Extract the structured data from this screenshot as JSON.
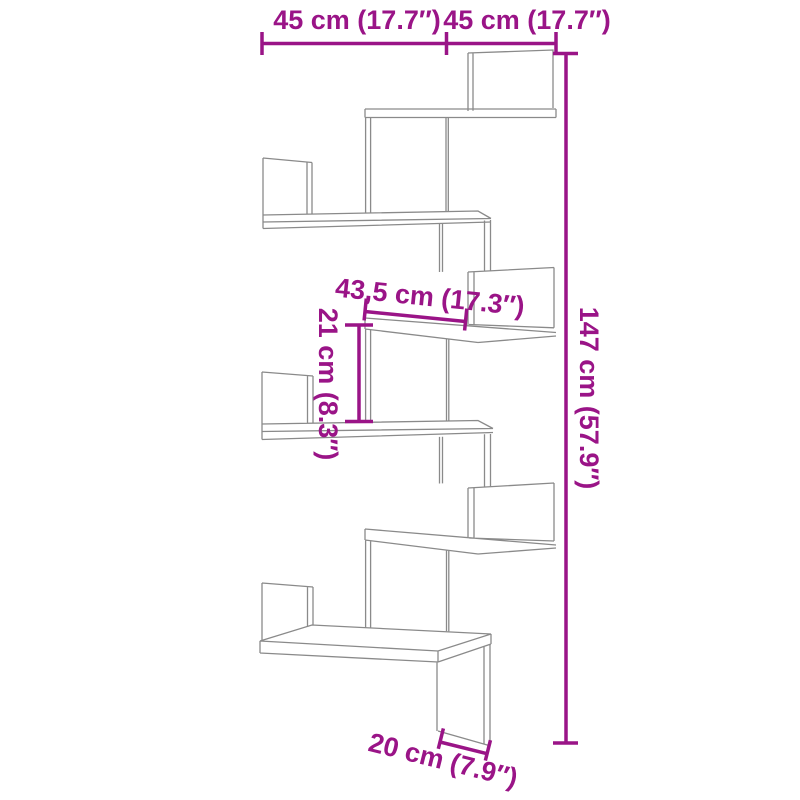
{
  "diagram": {
    "subject": "wall corner shelf dimension drawing",
    "colors": {
      "annotation": "#9a1487",
      "outline": "#8a8a8a",
      "background": "#ffffff"
    },
    "labels": {
      "top_width_left": "45 cm (17.7″)",
      "top_width_right": "45 cm (17.7″)",
      "shelf_width": "43,5 cm (17.3″)",
      "shelf_gap_height": "21 cm (8.3″)",
      "overall_height": "147 cm (57.9″)",
      "bottom_depth": "20 cm (7.9″)"
    }
  }
}
